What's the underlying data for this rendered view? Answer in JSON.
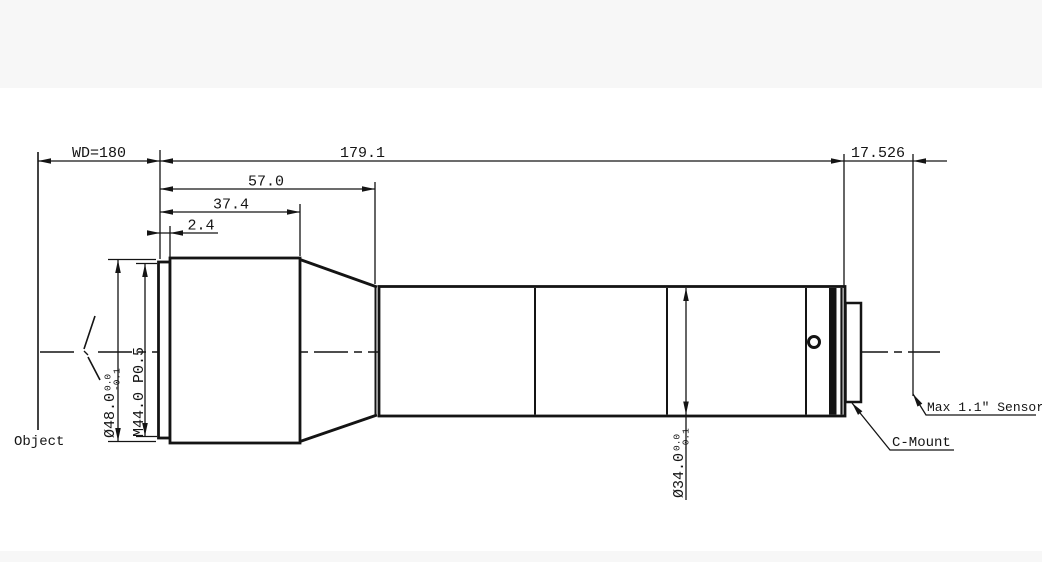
{
  "colors": {
    "line": "#141414",
    "background": "#ffffff",
    "band": "#f7f7f7"
  },
  "dims": {
    "wd": "WD=180",
    "total": "179.1",
    "flange": "17.526",
    "front": "57.0",
    "front_body": "37.4",
    "step": "2.4",
    "front_dia": "Ø48.0",
    "front_dia_tol_up": "0.0",
    "front_dia_tol_low": "-0.1",
    "thread": "M44.0 P0.5",
    "barrel_dia": "Ø34.0",
    "barrel_dia_tol_up": "0.0",
    "barrel_dia_tol_low": "-0.1"
  },
  "labels": {
    "object": "Object",
    "sensor": "Max 1.1″ Sensor",
    "mount": "C-Mount"
  }
}
